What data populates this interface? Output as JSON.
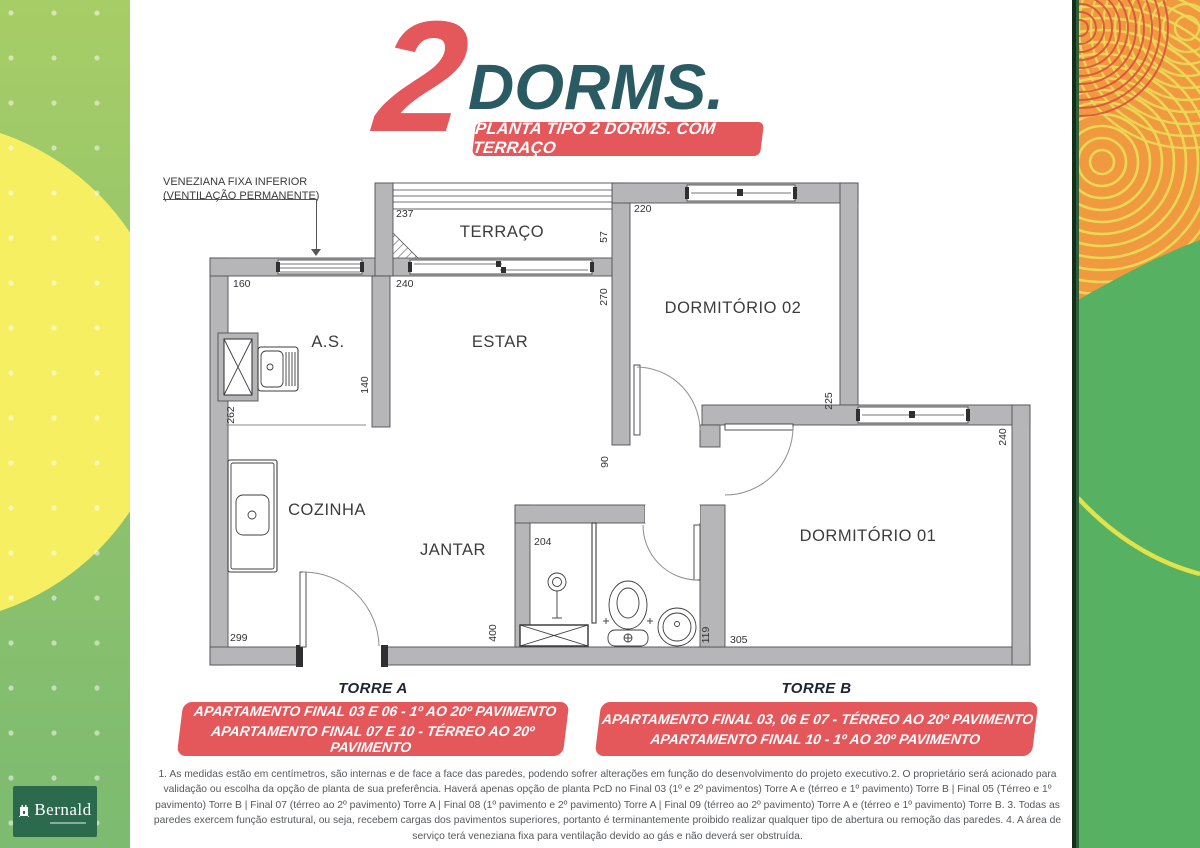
{
  "title": {
    "big_number": "2",
    "word": "DORMS.",
    "banner": "PLANTA TIPO 2 DORMS. COM TERRAÇO"
  },
  "annotation": {
    "line1": "VENEZIANA FIXA INFERIOR",
    "line2": "(VENTILAÇÃO PERMANENTE)"
  },
  "plan": {
    "rooms": {
      "terraco": "TERRAÇO",
      "as": "A.S.",
      "estar": "ESTAR",
      "dorm2": "DORMITÓRIO 02",
      "cozinha": "COZINHA",
      "jantar": "JANTAR",
      "dorm1": "DORMITÓRIO 01"
    },
    "dims": {
      "terraco_w": "237",
      "dorm2_w": "220",
      "terraco_d": "57",
      "estar_d": "270",
      "as_w": "160",
      "estar_w": "240",
      "as_d": "140",
      "as_h": "262",
      "hall_w": "90",
      "dorm2_h": "225",
      "dorm1_d": "240",
      "shower_w": "204",
      "jantar_d": "400",
      "cozinha_w": "299",
      "bath_w": "119",
      "dorm1_w": "305"
    }
  },
  "towers": {
    "a": {
      "label": "TORRE A",
      "lines": [
        "APARTAMENTO FINAL 03 E 06 - 1º AO 20º PAVIMENTO",
        "APARTAMENTO FINAL 07 E 10 - TÉRREO AO 20º PAVIMENTO"
      ]
    },
    "b": {
      "label": "TORRE B",
      "lines": [
        "APARTAMENTO FINAL 03, 06 E 07 - TÉRREO AO 20º PAVIMENTO",
        "APARTAMENTO FINAL 10 - 1º AO 20º PAVIMENTO"
      ]
    }
  },
  "footnote": "1. As medidas estão em centímetros, são internas e de face a face das paredes, podendo sofrer alterações em função do desenvolvimento do projeto executivo.2. O proprietário será acionado para validação ou escolha da opção de planta de sua preferência. Haverá apenas opção de planta PcD no Final 03 (1º e 2º pavimentos) Torre A e (térreo e 1º pavimento) Torre B | Final 05 (Térreo e 1º pavimento) Torre B | Final 07 (térreo ao 2º pavimento) Torre A | Final 08 (1º pavimento e 2º pavimento) Torre A | Final 09 (térreo ao 2º pavimento) Torre A e (térreo e 1º pavimento) Torre B. 3. Todas as paredes exercem função estrutural, ou seja, recebem cargas dos pavimentos superiores, portanto é terminantemente proibido realizar qualquer tipo de abertura ou remoção das paredes. 4. A área de serviço terá veneziana fixa para ventilação devido ao gás e não deverá ser obstruída.",
  "logo": {
    "name": "Bernald"
  },
  "colors": {
    "accent_red": "#e4575b",
    "title_teal": "#2a5b63",
    "wall_gray": "#b6b6b8",
    "band_yellow": "#f7ef62",
    "band_green_left": "#7cbb70",
    "band_green_right": "#56b163",
    "band_orange": "#f0993f",
    "logo_green": "#2c6a4d"
  }
}
